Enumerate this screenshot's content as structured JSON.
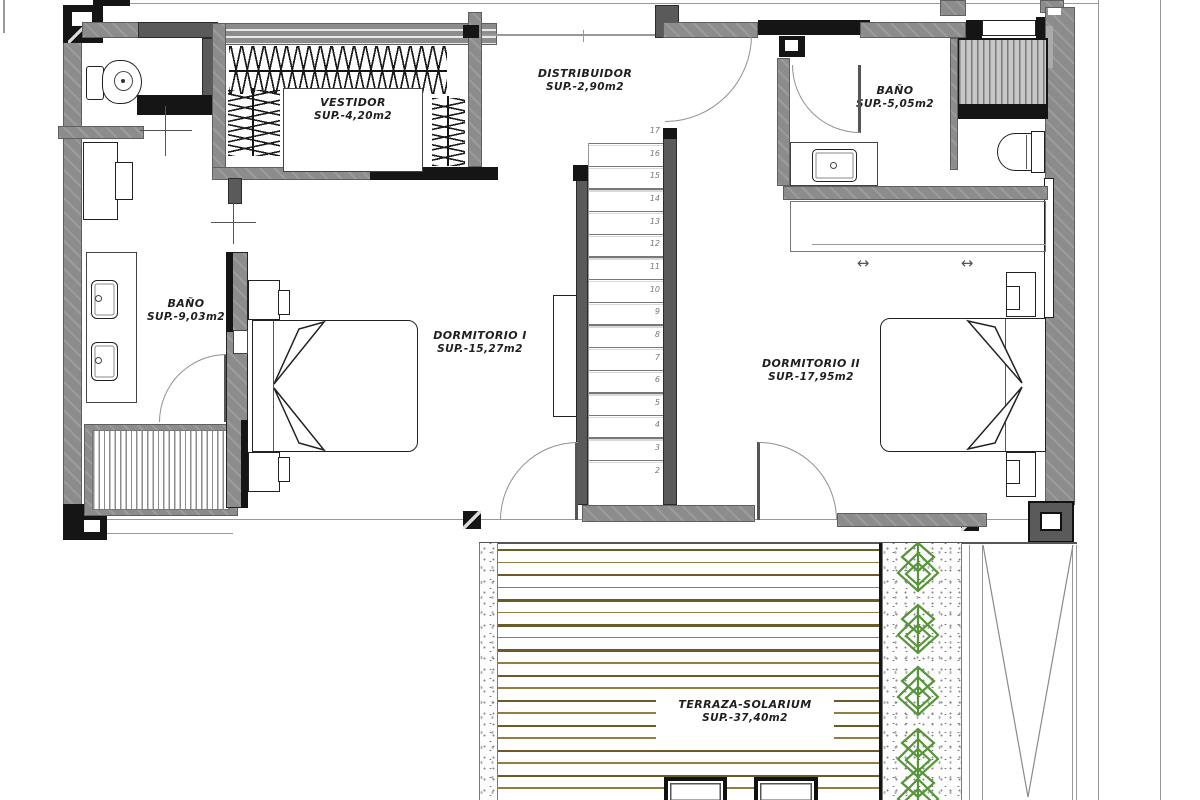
{
  "rooms": {
    "vestidor": {
      "label": "VESTIDOR",
      "area": "SUP.-4,20m2"
    },
    "distribuidor": {
      "label": "DISTRIBUIDOR",
      "area": "SUP.-2,90m2"
    },
    "bano_top": {
      "label": "BAÑO",
      "area": "SUP.-5,05m2"
    },
    "bano_left": {
      "label": "BAÑO",
      "area": "SUP.-9,03m2"
    },
    "dormitorio1": {
      "label": "DORMITORIO I",
      "area": "SUP.-15,27m2"
    },
    "dormitorio2": {
      "label": "DORMITORIO II",
      "area": "SUP.-17,95m2"
    },
    "terraza": {
      "label": "TERRAZA-SOLARIUM",
      "area": "SUP.-37,40m2"
    }
  },
  "stairs": {
    "steps": [
      "17",
      "16",
      "15",
      "14",
      "13",
      "12",
      "11",
      "10",
      "9",
      "8",
      "7",
      "6",
      "5",
      "4",
      "3",
      "2"
    ]
  },
  "icons": {
    "sliding_door_arrow": "↔"
  },
  "terrace": {
    "deck_line_count": 20,
    "plant_positions_y": [
      566,
      628,
      690,
      752,
      792
    ]
  },
  "colors": {
    "wall": "#8c8c8c",
    "wall_dark": "#5a5a5a",
    "black": "#151515",
    "deck_dark": "#6b5a2a",
    "deck_light": "#937d42",
    "plant": "#57953a",
    "line": "#999999"
  }
}
